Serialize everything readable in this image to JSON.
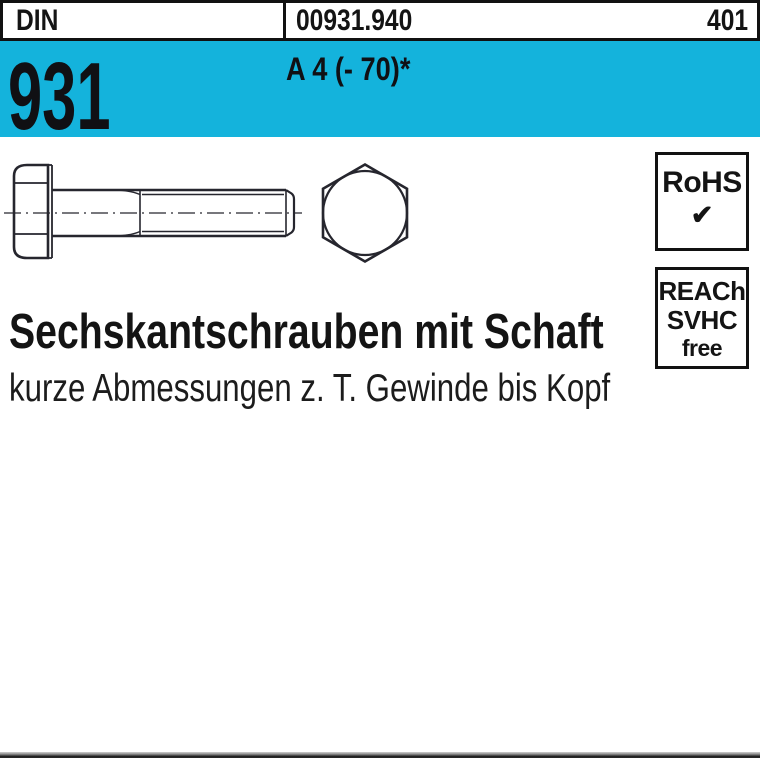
{
  "colors": {
    "banner_blue": "#14b3dc",
    "drawing_line": "#26262e",
    "text": "#141414"
  },
  "header": {
    "standard_label": "DIN",
    "article_number": "00931.940",
    "page_number": "401"
  },
  "banner": {
    "din_number": "931",
    "material_grade": "A 4 (- 70)*"
  },
  "badges": {
    "rohs": {
      "label": "RoHS",
      "check_icon": "✔"
    },
    "reach": {
      "line1": "REACh",
      "line2": "SVHC",
      "line3": "free"
    }
  },
  "product": {
    "title": "Sechskantschrauben mit Schaft",
    "subtitle": "kurze Abmessungen z. T. Gewinde bis Kopf"
  },
  "drawing": {
    "name": "hex-head-bolt-technical-drawing"
  }
}
